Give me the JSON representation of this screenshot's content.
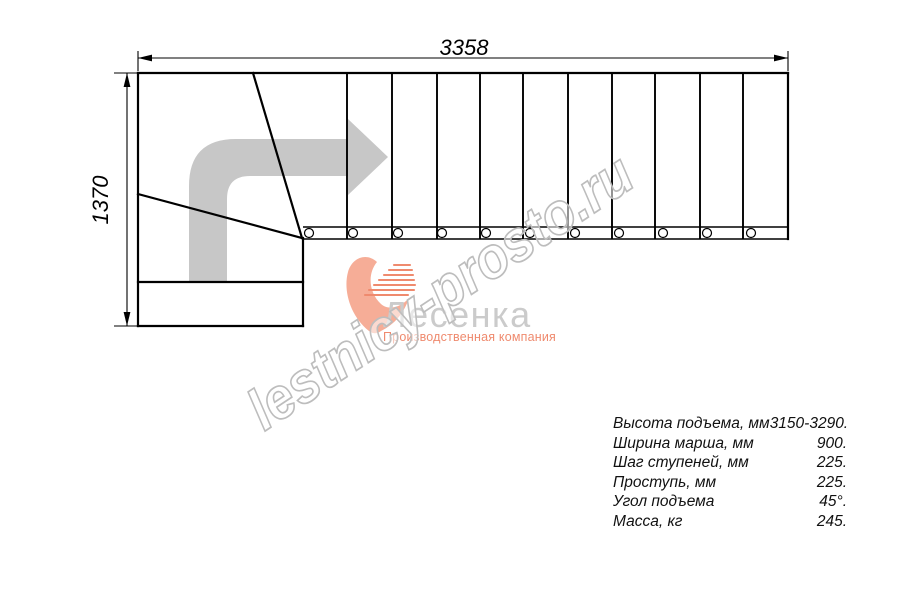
{
  "dimensions": {
    "width_mm": "3358",
    "height_mm": "1370"
  },
  "watermark": {
    "text": "lestnicy-prosto.ru"
  },
  "logo": {
    "brand": "Лесенка",
    "tagline": "Производственная компания"
  },
  "specs": {
    "rows": [
      {
        "label": "Высота подъема, мм",
        "value": "3150-3290."
      },
      {
        "label": "Ширина марша, мм",
        "value": "900."
      },
      {
        "label": "Шаг ступеней, мм",
        "value": "225."
      },
      {
        "label": "Проступь, мм",
        "value": "225."
      },
      {
        "label": "Угол подъема",
        "value": "45°."
      },
      {
        "label": "Масса, кг",
        "value": "245."
      }
    ]
  },
  "colors": {
    "line": "#000000",
    "arrow_gray": "#c7c7c7",
    "logo_gray": "#cbcbcb",
    "salmon": "#f6ad97",
    "salmon_dark": "#ef8a6e",
    "watermark_outline": "#bdbdbd"
  }
}
